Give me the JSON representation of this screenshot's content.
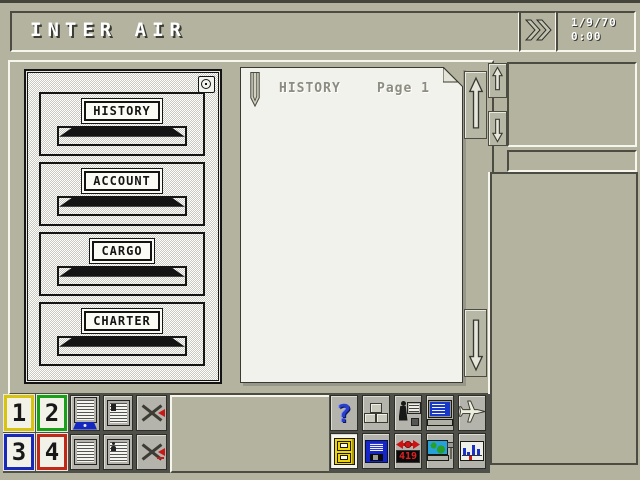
{
  "colors": {
    "background": "#b3b3a0",
    "bevel_dark": "#4c4c42",
    "bevel_light": "#f6f6ec",
    "paper": "#f2f2ec",
    "toolbar_slot": "#50504a",
    "accent_blue": "#2840cc",
    "accent_red": "#c81818",
    "cabinet_yellow": "#ecd410"
  },
  "header": {
    "title": "INTER AIR",
    "date": "1/9/70",
    "time": "0:00"
  },
  "cabinet": {
    "drawers": [
      {
        "label": "HISTORY"
      },
      {
        "label": "ACCOUNT"
      },
      {
        "label": "CARGO"
      },
      {
        "label": "CHARTER"
      }
    ]
  },
  "paper": {
    "title": "HISTORY",
    "page_label": "Page 1"
  },
  "toolbar": {
    "help_glyph": "?",
    "route_counter": "419",
    "number_buttons": [
      {
        "label": "1",
        "border_color": "#d8c410"
      },
      {
        "label": "2",
        "border_color": "#18a018"
      },
      {
        "label": "3",
        "border_color": "#1828b8"
      },
      {
        "label": "4",
        "border_color": "#c02818"
      }
    ],
    "icon_names": {
      "left_group": [
        "newspaper-icon",
        "aircraft-report-icon",
        "route-add-disabled-icon",
        "report-page-icon",
        "staff-report-icon",
        "route-remove-disabled-icon"
      ],
      "right_group": [
        "help-icon",
        "cargo-crates-icon",
        "staff-office-icon",
        "computer-icon",
        "airplane-icon",
        "filing-cabinet-icon",
        "floppy-disk-icon",
        "route-counter-icon",
        "world-map-icon",
        "statistics-icon"
      ]
    }
  }
}
